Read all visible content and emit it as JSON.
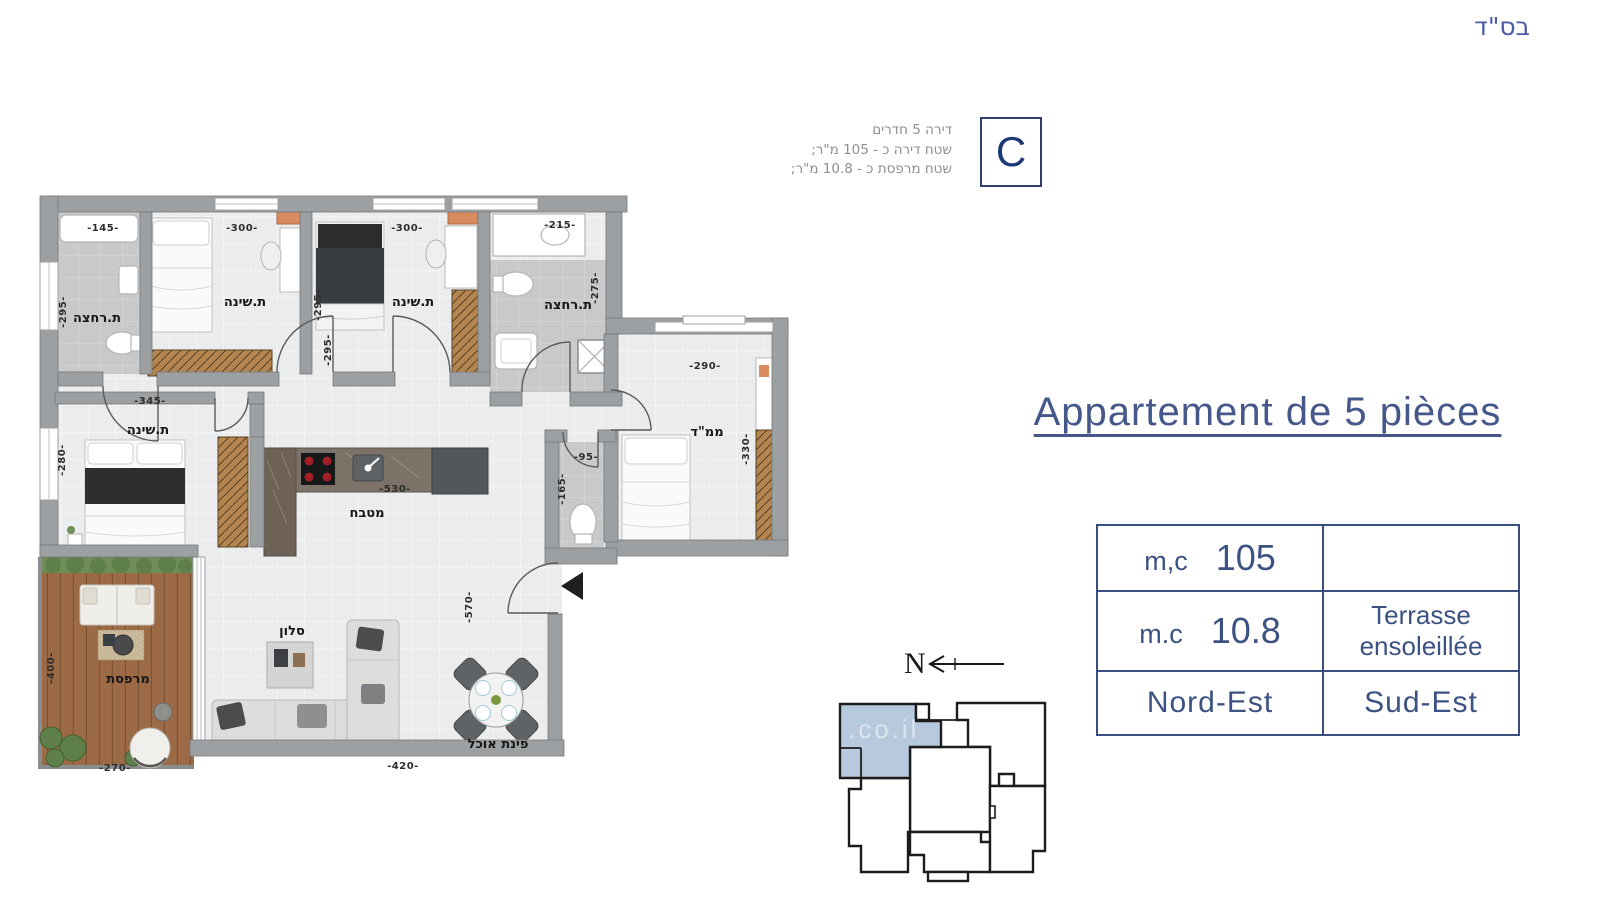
{
  "page": {
    "bsd": "בס\"ד"
  },
  "badge": {
    "letter": "C",
    "line1": "דירה 5 חדרים",
    "line2": "שטח דירה כ - 105 מ\"ר;",
    "line3": "שטח מרפסת כ - 10.8 מ\"ר;"
  },
  "title": {
    "text": "Appartement de 5 pièces"
  },
  "table": {
    "r1c1_label": "m,c",
    "r1c1_value": "105",
    "r1c2": "",
    "r2c1_label": "m.c",
    "r2c1_value": "10.8",
    "r2c2": "Terrasse ensoleillée",
    "r3c1": "Nord-Est",
    "r3c2": "Sud-Est"
  },
  "compass": {
    "label": "N"
  },
  "key_plan": {
    "watermark": ".co.il"
  },
  "floorplan": {
    "rooms": [
      {
        "id": "bathroom-1",
        "label": "ת.רחצה"
      },
      {
        "id": "bedroom-1",
        "label": "ת.שינה"
      },
      {
        "id": "bedroom-2",
        "label": "ת.שינה"
      },
      {
        "id": "bathroom-2",
        "label": "ת.רחצה"
      },
      {
        "id": "safe-room",
        "label": "ממ\"ד"
      },
      {
        "id": "master-bedroom",
        "label": "ת.שינה"
      },
      {
        "id": "kitchen",
        "label": "מטבח"
      },
      {
        "id": "living-room",
        "label": "סלון"
      },
      {
        "id": "dining",
        "label": "פינת אוכל"
      },
      {
        "id": "balcony",
        "label": "מרפסת"
      }
    ],
    "dims": [
      "-145-",
      "-300-",
      "-300-",
      "-215-",
      "-295-",
      "-295-",
      "-295-",
      "-275-",
      "-290-",
      "-330-",
      "-95-",
      "-165-",
      "-345-",
      "-280-",
      "-530-",
      "-570-",
      "-420-",
      "-400-",
      "-270-"
    ]
  },
  "colors": {
    "accent_blue": "#3c5282",
    "badge_navy": "#1d3a78",
    "wall_gray": "#9da0a2",
    "highlight_unit": "#b7cadd",
    "wood": "#b5854f",
    "deck": "#9c6b45"
  }
}
